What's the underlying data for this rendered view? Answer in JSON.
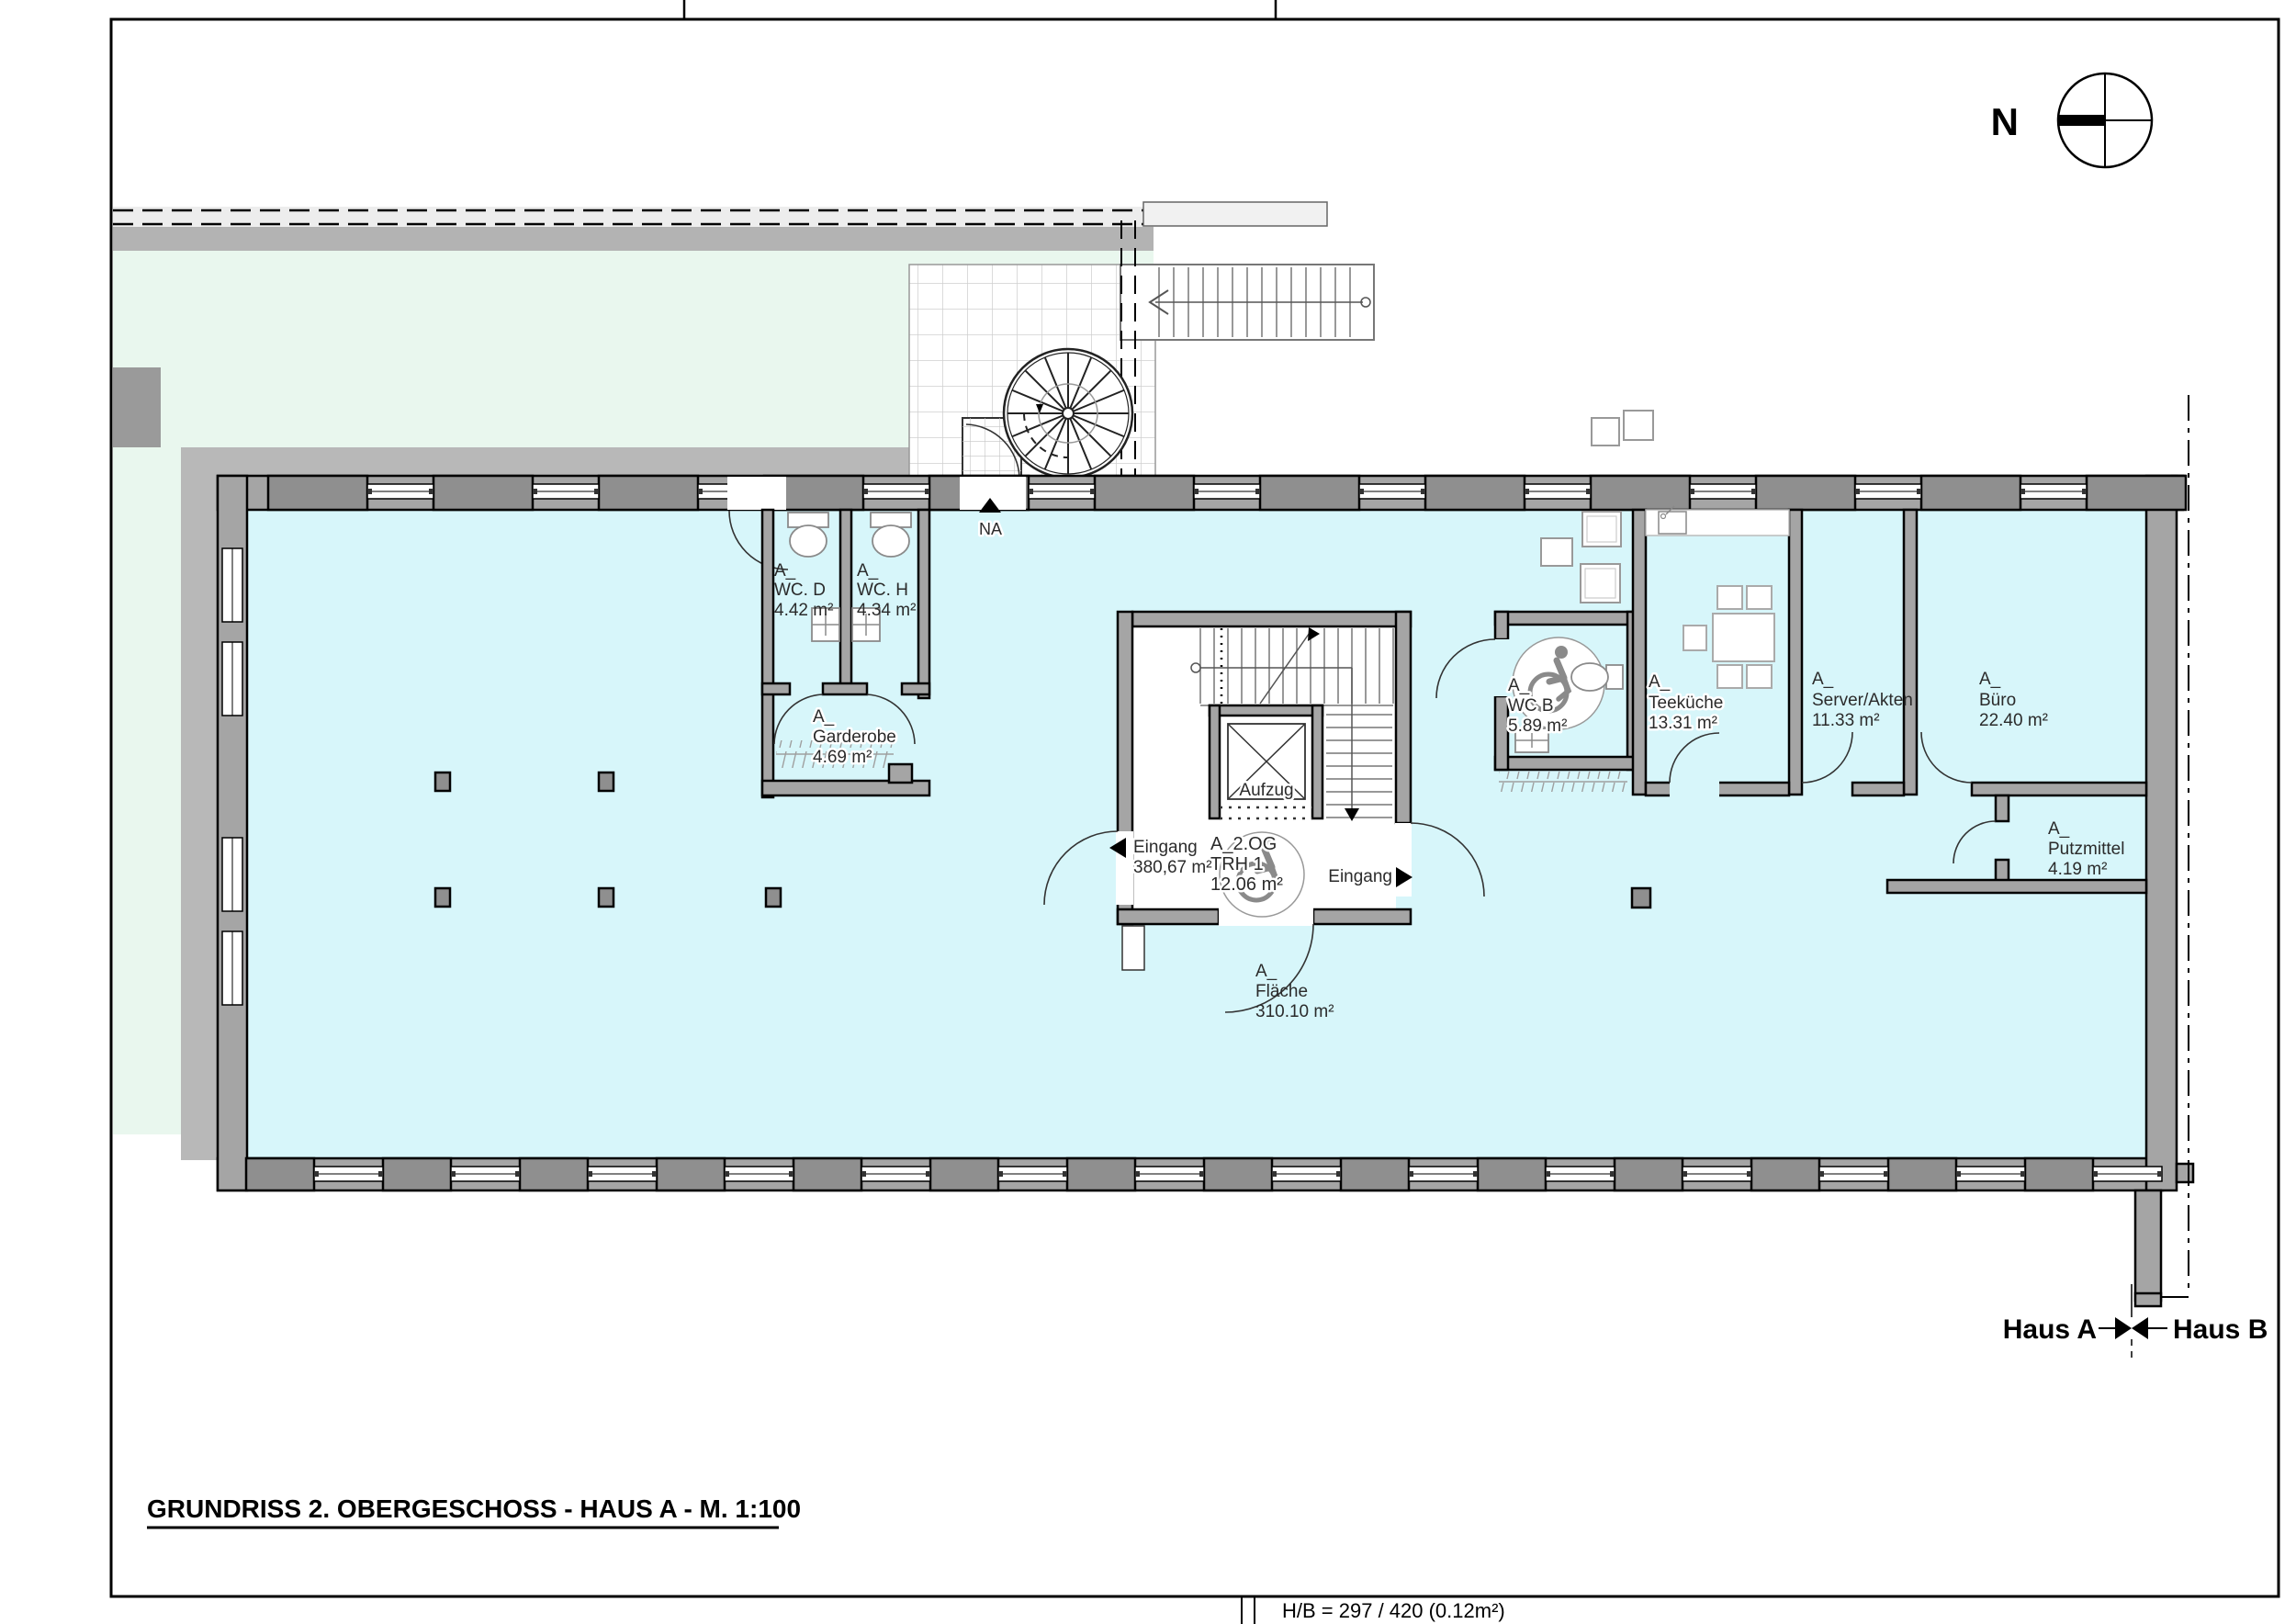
{
  "page": {
    "title": "GRUNDRISS 2. OBERGESCHOSS - HAUS A - M. 1:100",
    "footer": "H/B = 297 / 420 (0.12m²)"
  },
  "compass": {
    "label": "N"
  },
  "markers": {
    "na": "NA",
    "haus_a": "Haus A",
    "haus_b": "Haus B"
  },
  "elevator": {
    "label": "Aufzug"
  },
  "entrance_left": {
    "label": "Eingang",
    "area": "380,67 m²"
  },
  "entrance_right": {
    "label": "Eingang"
  },
  "rooms": {
    "wc_d": {
      "prefix": "A_",
      "name": "WC. D",
      "area": "4.42 m²"
    },
    "wc_h": {
      "prefix": "A_",
      "name": "WC. H",
      "area": "4.34 m²"
    },
    "garderobe": {
      "prefix": "A_",
      "name": "Garderobe",
      "area": "4.69 m²"
    },
    "trh": {
      "prefix": "A_2.OG",
      "name": "TRH 1",
      "area": "12.06 m²"
    },
    "wc_b": {
      "prefix": "A_",
      "name": "WC B",
      "area": "5.89 m²"
    },
    "teekueche": {
      "prefix": "A_",
      "name": "Teeküche",
      "area": "13.31 m²"
    },
    "server": {
      "prefix": "A_",
      "name": "Server/Akten",
      "area": "11.33 m²"
    },
    "buero": {
      "prefix": "A_",
      "name": "Büro",
      "area": "22.40 m²"
    },
    "putzmittel": {
      "prefix": "A_",
      "name": "Putzmittel",
      "area": "4.19 m²"
    },
    "flaeche": {
      "prefix": "A_",
      "name": "Fläche",
      "area": "310.10 m²"
    }
  },
  "colors": {
    "grass": "#e9f7ee",
    "floor": "#d7f6fa",
    "wall": "#a5a5a5",
    "walkway": "#b8b8b8"
  }
}
